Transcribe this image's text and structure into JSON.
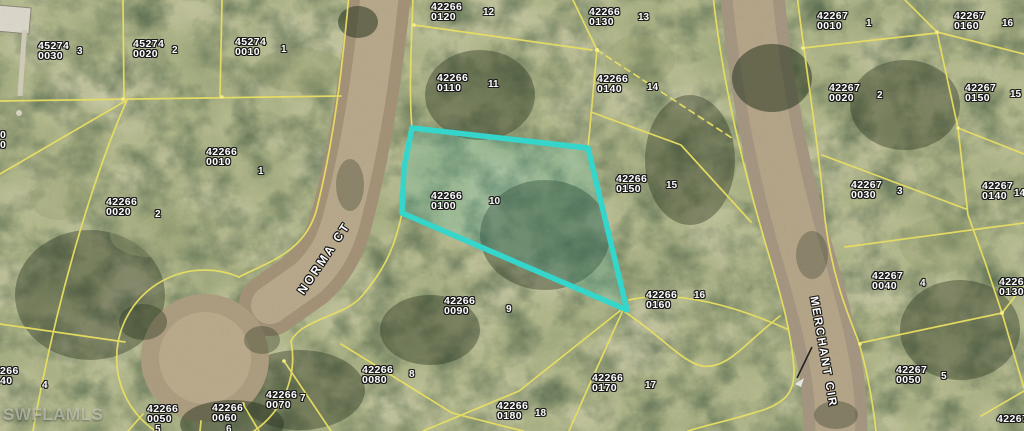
{
  "map": {
    "watermark": "SWFLAMLS",
    "streets": [
      {
        "name": "NORMA CT"
      },
      {
        "name": "MERCHANT CIR"
      }
    ],
    "colors": {
      "highlight": "#35d6cc",
      "highlight_fill": "rgba(56,204,194,0.17)",
      "parcel_line": "#e9df63",
      "label": "#ffffff"
    },
    "highlighted_parcel": {
      "strap": "42266",
      "unit": "0100",
      "lot": "10",
      "points": [
        [
          412,
          128
        ],
        [
          588,
          148
        ],
        [
          627,
          310
        ],
        [
          402,
          213
        ],
        [
          404,
          168
        ]
      ]
    },
    "parcel_labels": [
      {
        "line1": "45274",
        "line2": "0030",
        "x": 38,
        "y": 41
      },
      {
        "line1": "45274",
        "line2": "0020",
        "x": 133,
        "y": 39
      },
      {
        "line1": "45274",
        "line2": "0010",
        "x": 235,
        "y": 37
      },
      {
        "line1": "42266",
        "line2": "0010",
        "x": 206,
        "y": 147
      },
      {
        "line1": "42266",
        "line2": "0020",
        "x": 106,
        "y": 197
      },
      {
        "line1": "0",
        "line2": "0",
        "x": 0,
        "y": 130
      },
      {
        "line1": "266",
        "line2": "40",
        "x": 0,
        "y": 366
      },
      {
        "line1": "42266",
        "line2": "0050",
        "x": 147,
        "y": 404
      },
      {
        "line1": "42266",
        "line2": "0060",
        "x": 212,
        "y": 403
      },
      {
        "line1": "42266",
        "line2": "0070",
        "x": 266,
        "y": 390
      },
      {
        "line1": "42266",
        "line2": "0080",
        "x": 362,
        "y": 365
      },
      {
        "line1": "42266",
        "line2": "0090",
        "x": 444,
        "y": 296
      },
      {
        "line1": "42266",
        "line2": "0100",
        "x": 431,
        "y": 191
      },
      {
        "line1": "42266",
        "line2": "0110",
        "x": 437,
        "y": 73
      },
      {
        "line1": "42266",
        "line2": "0120",
        "x": 431,
        "y": 2
      },
      {
        "line1": "42266",
        "line2": "0130",
        "x": 589,
        "y": 7
      },
      {
        "line1": "42266",
        "line2": "0140",
        "x": 597,
        "y": 74
      },
      {
        "line1": "42266",
        "line2": "0150",
        "x": 616,
        "y": 174
      },
      {
        "line1": "42266",
        "line2": "0160",
        "x": 646,
        "y": 290
      },
      {
        "line1": "42266",
        "line2": "0170",
        "x": 592,
        "y": 373
      },
      {
        "line1": "42266",
        "line2": "0180",
        "x": 497,
        "y": 401
      },
      {
        "line1": "42267",
        "line2": "0010",
        "x": 817,
        "y": 11
      },
      {
        "line1": "42267",
        "line2": "0160",
        "x": 954,
        "y": 11
      },
      {
        "line1": "42267",
        "line2": "0020",
        "x": 829,
        "y": 83
      },
      {
        "line1": "42267",
        "line2": "0150",
        "x": 965,
        "y": 83
      },
      {
        "line1": "42267",
        "line2": "0030",
        "x": 851,
        "y": 180
      },
      {
        "line1": "42267",
        "line2": "0140",
        "x": 982,
        "y": 181
      },
      {
        "line1": "42267",
        "line2": "0040",
        "x": 872,
        "y": 271
      },
      {
        "line1": "42267",
        "line2": "0050",
        "x": 896,
        "y": 365
      },
      {
        "line1": "42267",
        "line2": "0130",
        "x": 999,
        "y": 277
      },
      {
        "line1": "42267",
        "line2": "",
        "x": 997,
        "y": 414
      }
    ],
    "lot_numbers": [
      {
        "n": "3",
        "x": 77,
        "y": 46
      },
      {
        "n": "2",
        "x": 172,
        "y": 45
      },
      {
        "n": "1",
        "x": 281,
        "y": 44
      },
      {
        "n": "1",
        "x": 258,
        "y": 166
      },
      {
        "n": "2",
        "x": 155,
        "y": 209
      },
      {
        "n": "4",
        "x": 42,
        "y": 380
      },
      {
        "n": "5",
        "x": 155,
        "y": 424
      },
      {
        "n": "6",
        "x": 226,
        "y": 424
      },
      {
        "n": "7",
        "x": 300,
        "y": 393
      },
      {
        "n": "8",
        "x": 409,
        "y": 369
      },
      {
        "n": "9",
        "x": 506,
        "y": 304
      },
      {
        "n": "10",
        "x": 489,
        "y": 196
      },
      {
        "n": "11",
        "x": 488,
        "y": 79
      },
      {
        "n": "12",
        "x": 483,
        "y": 7
      },
      {
        "n": "13",
        "x": 638,
        "y": 12
      },
      {
        "n": "14",
        "x": 647,
        "y": 82
      },
      {
        "n": "15",
        "x": 666,
        "y": 180
      },
      {
        "n": "16",
        "x": 694,
        "y": 290
      },
      {
        "n": "17",
        "x": 645,
        "y": 380
      },
      {
        "n": "18",
        "x": 535,
        "y": 408
      },
      {
        "n": "1",
        "x": 866,
        "y": 18
      },
      {
        "n": "16",
        "x": 1002,
        "y": 18
      },
      {
        "n": "2",
        "x": 877,
        "y": 90
      },
      {
        "n": "15",
        "x": 1010,
        "y": 89
      },
      {
        "n": "3",
        "x": 897,
        "y": 186
      },
      {
        "n": "14",
        "x": 1014,
        "y": 188
      },
      {
        "n": "4",
        "x": 920,
        "y": 278
      },
      {
        "n": "5",
        "x": 941,
        "y": 371
      }
    ]
  }
}
